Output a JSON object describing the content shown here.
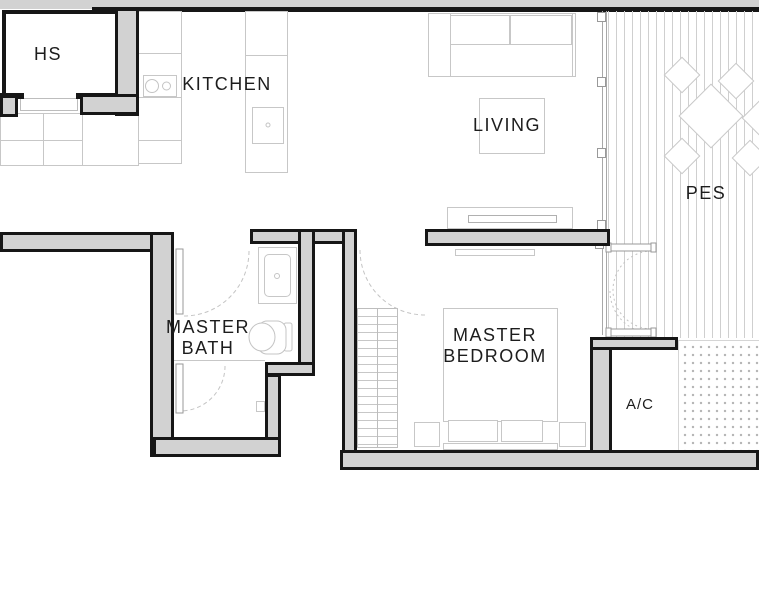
{
  "plan": {
    "type": "apartment-floor-plan",
    "rooms": [
      {
        "id": "hs",
        "lines": [
          "HS"
        ]
      },
      {
        "id": "kitchen",
        "lines": [
          "KITCHEN"
        ]
      },
      {
        "id": "living",
        "lines": [
          "LIVING"
        ]
      },
      {
        "id": "pes",
        "lines": [
          "PES"
        ]
      },
      {
        "id": "master-bath",
        "lines": [
          "MASTER",
          "BATH"
        ]
      },
      {
        "id": "master-bedroom",
        "lines": [
          "MASTER",
          "BEDROOM"
        ]
      },
      {
        "id": "ac-ledge",
        "lines": [
          "A/C"
        ]
      }
    ],
    "colors": {
      "background": "#ffffff",
      "wall_fill": "#d2d2d2",
      "wall_line": "#161616",
      "fixture_line": "#c7c7c7",
      "hatch_line": "#cfcfcf",
      "dot_fill": "#b4b4b4",
      "text": "#1d1d1d"
    },
    "fixtures": [
      "sofa",
      "coffee-table",
      "tv-console",
      "dining-table",
      "dining-chair",
      "bed",
      "wardrobe",
      "bedside-table",
      "pillows",
      "toilet",
      "vanity-sink",
      "shower-door",
      "kitchen-hob",
      "kitchen-sink",
      "hs-step",
      "sliding-door-track",
      "decking-hatch",
      "ac-ledge-dots"
    ]
  }
}
